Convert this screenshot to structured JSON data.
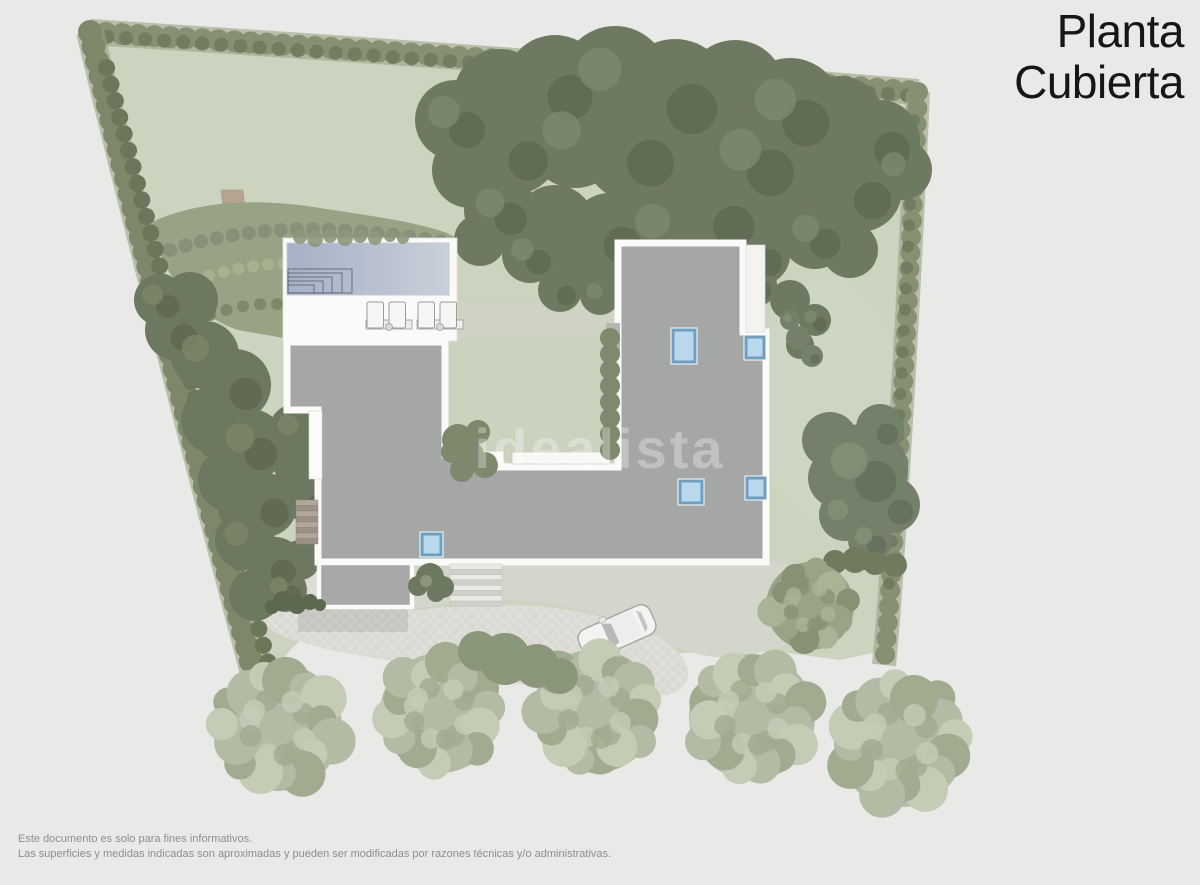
{
  "title": {
    "line1": "Planta",
    "line2": "Cubierta"
  },
  "watermark": "idealista",
  "footer": {
    "line1": "Este documento es solo para fines informativos.",
    "line2": "Las superficies y medidas indicadas son aproximadas y pueden ser modificadas por razones técnicas y/o administrativas."
  },
  "site": {
    "skylight_count": 5,
    "sun_lounger_count": 4,
    "car_count": 1,
    "bottom_tree_count": 5
  },
  "colors": {
    "title": "#161616",
    "footer_text": "#8e8e8e",
    "page_bg": "#e9e9e7",
    "roof": "#a5a6a6",
    "roof_border": "#fafaf8",
    "lawn": "#ccd3bf",
    "hedge": "#869072",
    "dense_trees": "#6e7962",
    "bottom_trees": "#b2bba3",
    "pool_left": "#a7b1c6",
    "pool_right": "#c9d0db",
    "skylight_fill": "#b9d8ec",
    "skylight_border": "#6f9ec0",
    "driveway": "#dad9d3",
    "car_body": "#f3f3f1"
  }
}
